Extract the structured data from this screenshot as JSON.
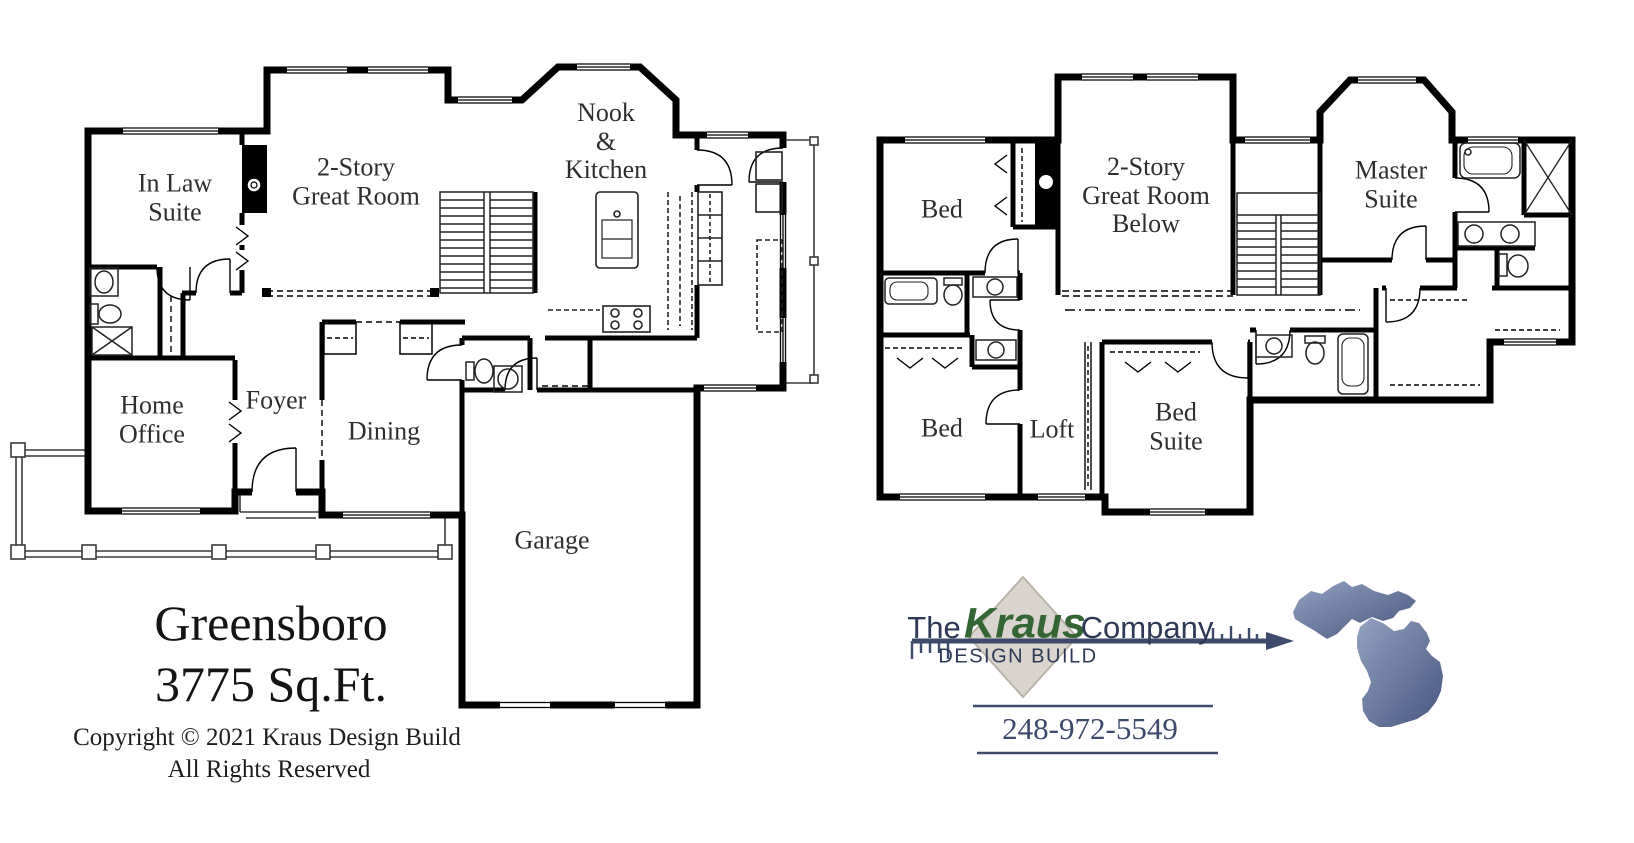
{
  "sheet": {
    "plan_title": "Greensboro",
    "plan_area": "3775 Sq.Ft.",
    "copyright_line1": "Copyright © 2021 Kraus Design Build",
    "copyright_line2": "All Rights Reserved"
  },
  "first_floor": {
    "rooms": [
      {
        "id": "in-law-suite",
        "label": "In Law\nSuite",
        "x": 175,
        "y": 198
      },
      {
        "id": "great-room",
        "label": "2-Story\nGreat Room",
        "x": 356,
        "y": 182
      },
      {
        "id": "nook-kitchen",
        "label": "Nook\n&\nKitchen",
        "x": 606,
        "y": 142
      },
      {
        "id": "home-office",
        "label": "Home\nOffice",
        "x": 152,
        "y": 420
      },
      {
        "id": "foyer",
        "label": "Foyer",
        "x": 276,
        "y": 401
      },
      {
        "id": "dining",
        "label": "Dining",
        "x": 384,
        "y": 432
      },
      {
        "id": "garage",
        "label": "Garage",
        "x": 552,
        "y": 541
      }
    ]
  },
  "second_floor": {
    "rooms": [
      {
        "id": "bed-front",
        "label": "Bed",
        "x": 942,
        "y": 210
      },
      {
        "id": "great-room-below",
        "label": "2-Story\nGreat Room\nBelow",
        "x": 1146,
        "y": 196
      },
      {
        "id": "master-suite",
        "label": "Master\nSuite",
        "x": 1391,
        "y": 185
      },
      {
        "id": "bed-rear",
        "label": "Bed",
        "x": 942,
        "y": 429
      },
      {
        "id": "loft",
        "label": "Loft",
        "x": 1052,
        "y": 430
      },
      {
        "id": "bed-suite",
        "label": "Bed\nSuite",
        "x": 1176,
        "y": 427
      }
    ]
  },
  "logo": {
    "prefix": "The",
    "brand": "Kraus",
    "suffix": "Company",
    "tagline": "DESIGN BUILD",
    "phone": "248-972-5549",
    "brand_color": "#336633",
    "text_color": "#2e3a55",
    "arrow_color": "#3d4a6b",
    "diamond_color": "#d9d5ce",
    "michigan_dark": "#46567e",
    "michigan_light": "#93a2c0"
  }
}
